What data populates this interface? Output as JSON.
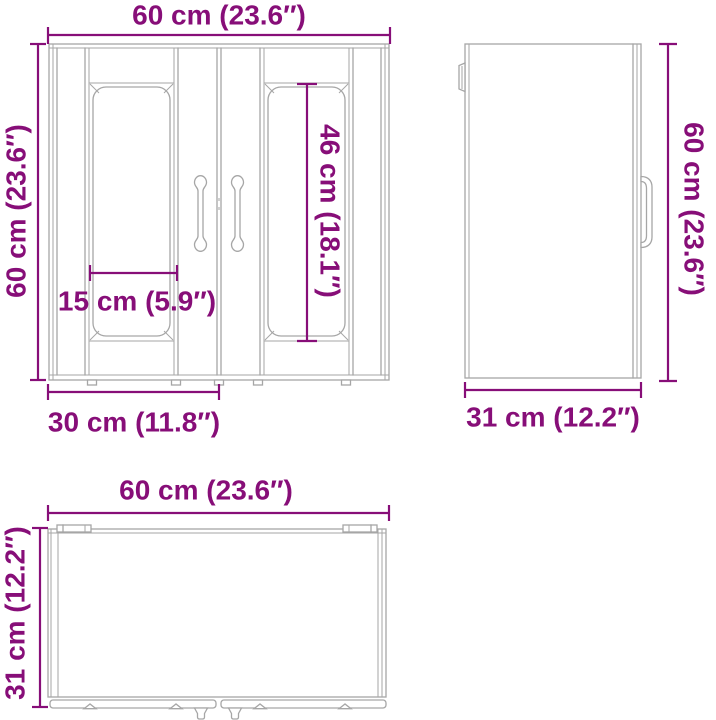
{
  "diagram": {
    "dimension_color": "#870e78",
    "line_color": "#a6a6a6",
    "front": {
      "width_label": "60 cm (23.6″)",
      "height_label": "60 cm (23.6″)",
      "panel_width_label": "15 cm (5.9″)",
      "panel_height_label": "46 cm (18.1″)",
      "door_width_label": "30 cm (11.8″)"
    },
    "side": {
      "height_label": "60 cm (23.6″)",
      "depth_label": "31 cm (12.2″)"
    },
    "top": {
      "width_label": "60 cm (23.6″)",
      "depth_label": "31 cm (12.2″)"
    }
  }
}
